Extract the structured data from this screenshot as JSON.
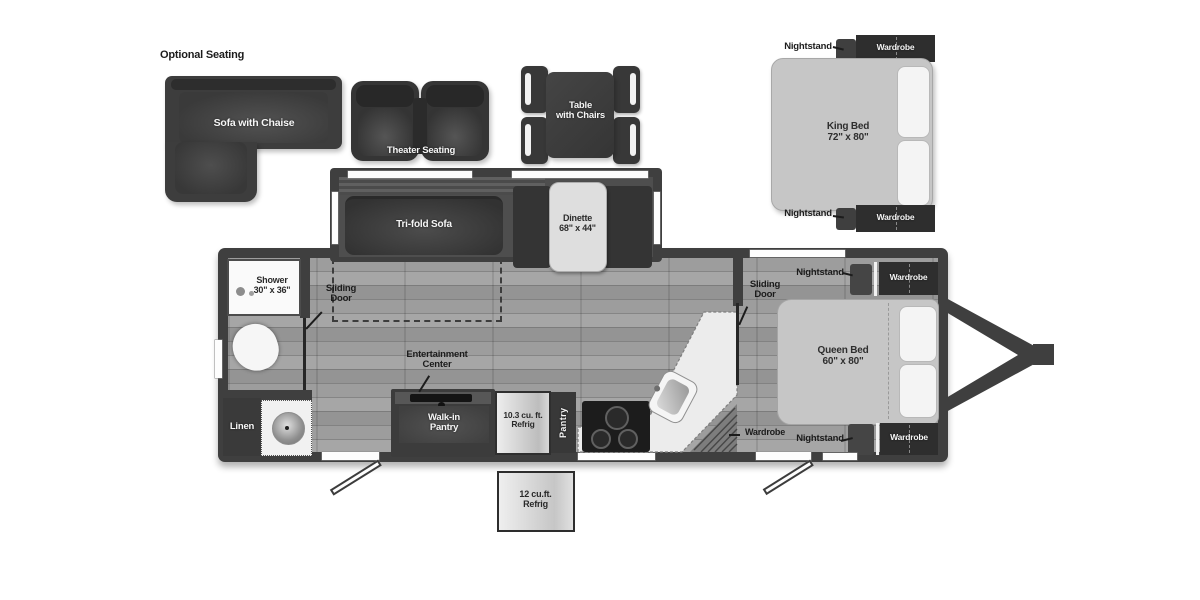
{
  "floorplan": {
    "optional_seating": {
      "heading": "Optional Seating",
      "sofa_with_chaise": "Sofa with Chaise",
      "theater_seating": "Theater Seating",
      "table_with_chairs": "Table\nwith Chairs"
    },
    "king_bed_option": {
      "bed": "King Bed\n72\" x 80\"",
      "nightstand_top": "Nightstand",
      "nightstand_bottom": "Nightstand",
      "wardrobe_top": "Wardrobe",
      "wardrobe_bottom": "Wardrobe"
    },
    "slide_out": {
      "tri_fold_sofa": "Tri-fold Sofa",
      "dinette": "Dinette\n68\" x 44\""
    },
    "bathroom": {
      "shower": "Shower\n30\" x 36\"",
      "sliding_door": "Sliding\nDoor",
      "linen": "Linen"
    },
    "galley": {
      "entertainment_center": "Entertainment\nCenter",
      "walk_in_pantry": "Walk-in\nPantry",
      "refrig_103": "10.3 cu. ft.\nRefrig",
      "pantry": "Pantry"
    },
    "bedroom": {
      "sliding_door": "Sliding\nDoor",
      "queen_bed": "Queen Bed\n60\" x 80\"",
      "wardrobe_floor": "Wardrobe",
      "nightstand_top": "Nightstand",
      "nightstand_bottom": "Nightstand",
      "wardrobe_top": "Wardrobe",
      "wardrobe_bottom": "Wardrobe"
    },
    "exterior": {
      "refrig_12": "12 cu.ft.\nRefrig"
    },
    "colors": {
      "furniture_dark": "#3d3d3d",
      "wall_dark": "#3f3f3f",
      "bed_light": "#c6c6c6",
      "floor_mid": "#8e8e8e",
      "fixture_white": "#f7f7f7"
    }
  }
}
